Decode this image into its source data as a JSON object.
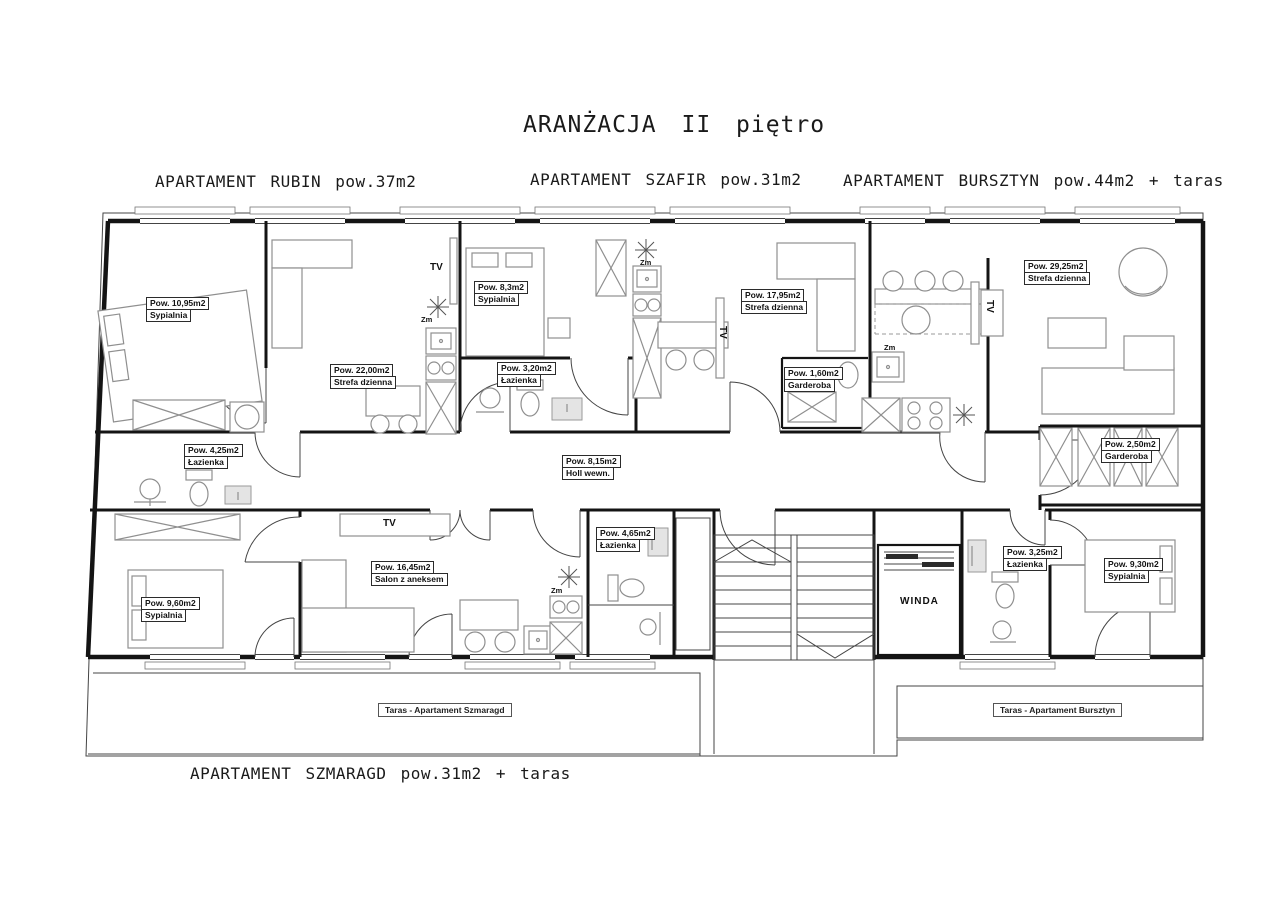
{
  "title": "ARANŻACJA II piętro",
  "apartments": {
    "rubin": {
      "label": "APARTAMENT RUBIN pow.37m2"
    },
    "szafir": {
      "label": "APARTAMENT SZAFIR pow.31m2"
    },
    "bursztyn": {
      "label": "APARTAMENT BURSZTYN pow.44m2 + taras"
    },
    "szmaragd": {
      "label": "APARTAMENT SZMARAGD pow.31m2 + taras"
    }
  },
  "rooms": {
    "rubin_sypialnia": {
      "area": "Pow. 10,95m2",
      "name": "Sypialnia"
    },
    "rubin_strefa": {
      "area": "Pow. 22,00m2",
      "name": "Strefa dzienna"
    },
    "rubin_lazienka": {
      "area": "Pow. 4,25m2",
      "name": "Łazienka"
    },
    "szafir_sypialnia": {
      "area": "Pow. 8,3m2",
      "name": "Sypialnia"
    },
    "szafir_lazienka": {
      "area": "Pow. 3,20m2",
      "name": "Łazienka"
    },
    "szafir_strefa": {
      "area": "Pow. 17,95m2",
      "name": "Strefa dzienna"
    },
    "bursztyn_garderoba_1": {
      "area": "Pow. 1,60m2",
      "name": "Garderoba"
    },
    "bursztyn_strefa": {
      "area": "Pow. 29,25m2",
      "name": "Strefa dzienna"
    },
    "bursztyn_garderoba_2": {
      "area": "Pow. 2,50m2",
      "name": "Garderoba"
    },
    "holl": {
      "area": "Pow. 8,15m2",
      "name": "Holl wewn."
    },
    "szmaragd_lazienka": {
      "area": "Pow. 4,65m2",
      "name": "Łazienka"
    },
    "szmaragd_salon": {
      "area": "Pow. 16,45m2",
      "name": "Salon z aneksem"
    },
    "szmaragd_sypialnia": {
      "area": "Pow. 9,60m2",
      "name": "Sypialnia"
    },
    "bursztyn_lazienka": {
      "area": "Pow. 3,25m2",
      "name": "Łazienka"
    },
    "bursztyn_sypialnia": {
      "area": "Pow. 9,30m2",
      "name": "Sypialnia"
    }
  },
  "annotations": {
    "tv": "TV",
    "zm": "Zm",
    "winda": "WINDA",
    "taras_szmaragd": "Taras - Apartament Szmaragd",
    "taras_bursztyn": "Taras - Apartament Bursztyn"
  },
  "colors": {
    "line": "#141414",
    "furniture": "#8f8f8f",
    "background": "#ffffff"
  }
}
